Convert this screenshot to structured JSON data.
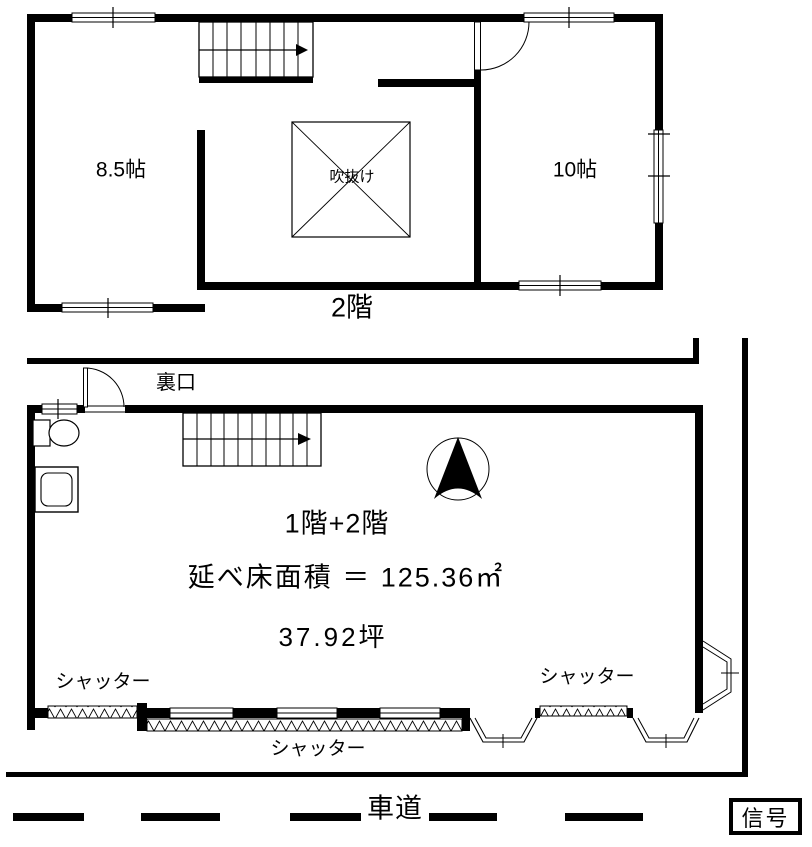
{
  "colors": {
    "line": "#000000",
    "background": "#ffffff"
  },
  "second_floor": {
    "floor_label": "2階",
    "room_left_label": "8.5帖",
    "room_right_label": "10帖",
    "void_label": "吹抜け"
  },
  "first_floor": {
    "back_door_label": "裏口",
    "floors_label": "1階+2階",
    "total_area_label": "延べ床面積 ＝ 125.36㎡",
    "tsubo_area_label": "37.92坪",
    "shutter_left_label": "シャッター",
    "shutter_right_label": "シャッター",
    "shutter_bottom_label": "シャッター"
  },
  "road": {
    "label": "車道",
    "signal_label": "信号"
  }
}
